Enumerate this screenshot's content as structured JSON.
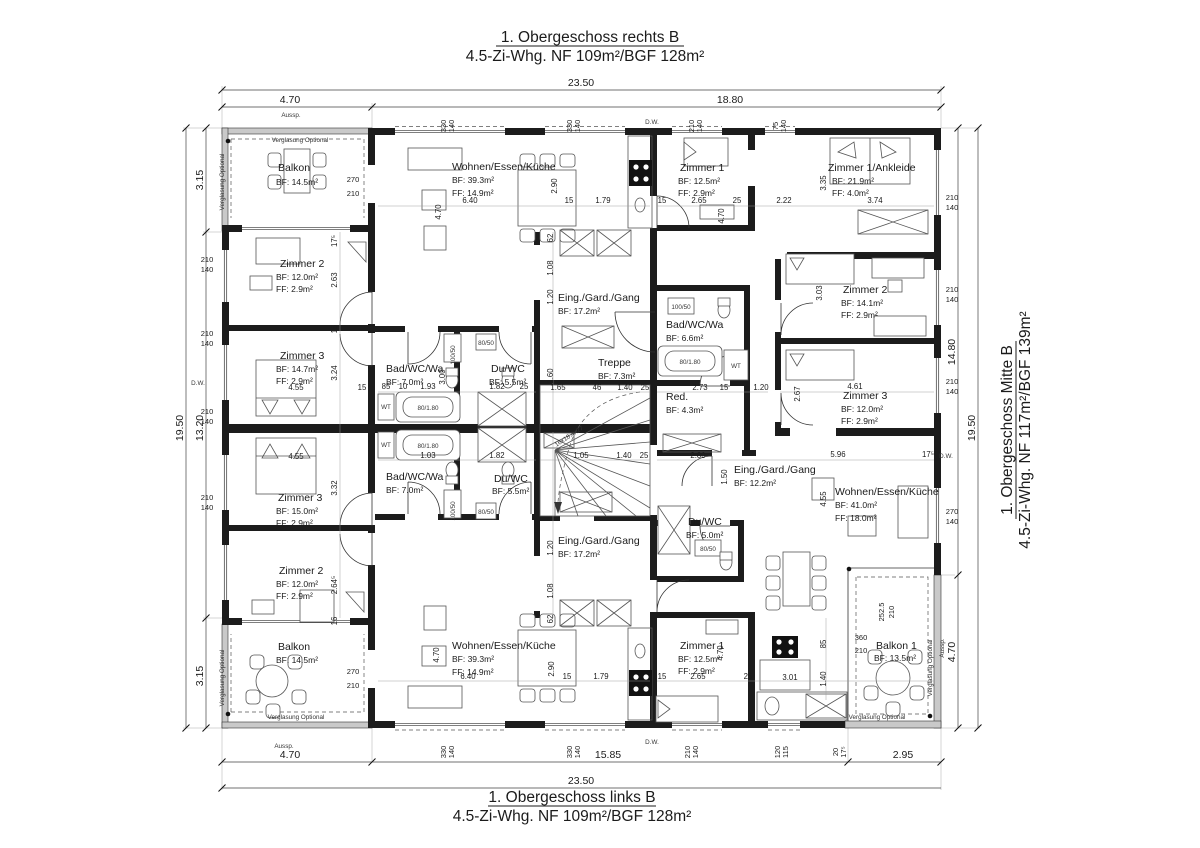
{
  "titles": {
    "top1": "1. Obergeschoss rechts B",
    "top2": "4.5-Zi-Whg. NF 109m²/BGF 128m²",
    "bottom1": "1. Obergeschoss links B",
    "bottom2": "4.5-Zi-Whg. NF 109m²/BGF 128m²",
    "right1": "1. Obergeschoss Mitte B",
    "right2": "4.5-Zi-Whg. NF 117m²/BGF 139m²"
  },
  "rooms": [
    {
      "name": "Balkon",
      "bf": "BF: 14.5m²"
    },
    {
      "name": "Zimmer 2",
      "bf": "BF: 12.0m²",
      "ff": "FF: 2.9m²"
    },
    {
      "name": "Zimmer 3",
      "bf": "BF: 14.7m²",
      "ff": "FF: 2.9m²"
    },
    {
      "name": "Zimmer 3",
      "bf": "BF: 15.0m²",
      "ff": "FF: 2.9m²"
    },
    {
      "name": "Zimmer 2",
      "bf": "BF: 12.0m²",
      "ff": "FF: 2.9m²"
    },
    {
      "name": "Balkon",
      "bf": "BF: 14.5m²"
    },
    {
      "name": "Wohnen/Essen/Küche",
      "bf": "BF: 39.3m²",
      "ff": "FF: 14.9m²"
    },
    {
      "name": "Wohnen/Essen/Küche",
      "bf": "BF: 39.3m²",
      "ff": "FF: 14.9m²"
    },
    {
      "name": "Bad/WC/Wa",
      "bf": "BF: 7.0m²"
    },
    {
      "name": "Du/WC",
      "bf": "BF: 5.5m²"
    },
    {
      "name": "Bad/WC/Wa",
      "bf": "BF: 7.0m²"
    },
    {
      "name": "Du/WC",
      "bf": "BF: 5.5m²"
    },
    {
      "name": "Eing./Gard./Gang",
      "bf": "BF: 17.2m²"
    },
    {
      "name": "Eing./Gard./Gang",
      "bf": "BF: 17.2m²"
    },
    {
      "name": "Treppe",
      "bf": "BF: 7.3m²"
    },
    {
      "name": "Zimmer 1",
      "bf": "BF: 12.5m²",
      "ff": "FF: 2.9m²"
    },
    {
      "name": "Zimmer 1",
      "bf": "BF: 12.5m²",
      "ff": "FF: 2.9m²"
    },
    {
      "name": "Bad/WC/Wa",
      "bf": "BF: 6.6m²"
    },
    {
      "name": "Red.",
      "bf": "BF: 4.3m²"
    },
    {
      "name": "Eing./Gard./Gang",
      "bf": "BF: 12.2m²"
    },
    {
      "name": "Du/WC",
      "bf": "BF: 5.0m²"
    },
    {
      "name": "Zimmer 1/Ankleide",
      "bf": "BF: 21.9m²",
      "ff": "FF: 4.0m²"
    },
    {
      "name": "Zimmer 2",
      "bf": "BF: 14.1m²",
      "ff": "FF: 2.9m²"
    },
    {
      "name": "Zimmer 3",
      "bf": "BF: 12.0m²",
      "ff": "FF: 2.9m²"
    },
    {
      "name": "Wohnen/Essen/Küche",
      "bf": "BF: 41.0m²",
      "ff": "FF: 18.0m²"
    },
    {
      "name": "Balkon 1",
      "bf": "BF: 13.5m²"
    }
  ],
  "chains": {
    "top_total": "23.50",
    "top_a": "4.70",
    "top_b": "18.80",
    "bottom_a": "4.70",
    "bottom_b": "15.85",
    "bottom_c": "2.95",
    "bottom_total": "23.50",
    "left_total": "19.50",
    "left_a": "3.15",
    "left_b": "13.20",
    "left_c": "3.15",
    "right_total": "19.50",
    "right_a": "14.80",
    "right_b": "4.70"
  },
  "windows": {
    "top": [
      [
        "330",
        "140"
      ],
      [
        "330",
        "140"
      ],
      [
        "210",
        "140"
      ],
      [
        "75",
        "140"
      ]
    ],
    "bottom": [
      [
        "330",
        "140"
      ],
      [
        "330",
        "140"
      ],
      [
        "210",
        "140"
      ],
      [
        "120",
        "115"
      ]
    ],
    "left": [
      "210",
      "140"
    ],
    "right": [
      [
        "210",
        "140"
      ],
      [
        "270",
        "140"
      ]
    ],
    "balc_tl": [
      "270",
      "210"
    ],
    "balc_bl": [
      "270",
      "210"
    ],
    "balc_br1": [
      "252.5",
      "210"
    ],
    "balc_br2": [
      "360",
      "210"
    ],
    "b20": [
      "20",
      "17⁵"
    ]
  },
  "ann": {
    "verglasung": "Verglasung Optional",
    "aussp": "Aussp.",
    "dw": "D.W.",
    "stair": "16x18.4x27",
    "tub": "80/1.80",
    "shower": "80/50",
    "washer": "100/50",
    "wt": "WT"
  },
  "dims": [
    "4.70",
    "6.40",
    "2.90",
    "15",
    "1.79",
    "62",
    "1.08",
    "1.20",
    "15",
    "2.65",
    "25",
    "2.22",
    "3.35",
    "3.74",
    "4.70",
    "17⁵",
    "2.63",
    "15",
    "3.24",
    "4.55",
    "15",
    "3.32",
    "4.55",
    "2.64⁵",
    "16",
    "85",
    "10",
    "1.93",
    "3.00",
    "1.82",
    "25",
    "1.03",
    "1.82",
    "1.05",
    "1.40",
    "25",
    "2.80",
    "1.65",
    "46",
    "1.40",
    "25",
    "2.73",
    "15",
    "1.20",
    "4.61",
    "2.67",
    "3.03",
    "5.96",
    "1.50",
    "4.55",
    "17⁵",
    "3.01",
    "85",
    "1.40",
    "2.65",
    "15",
    "25",
    "4.70",
    "1.79",
    "2.90",
    "15",
    "6.40",
    "4.70",
    "1.20",
    "1.08",
    "62",
    "1.60"
  ]
}
